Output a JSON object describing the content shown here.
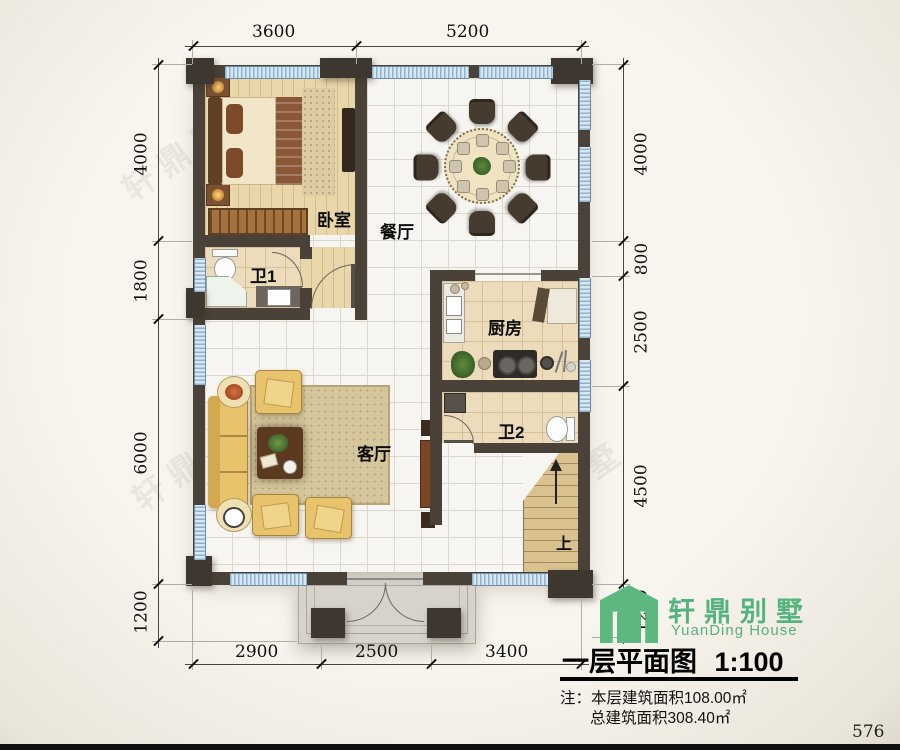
{
  "drawing": {
    "type": "floor-plan",
    "title": "一层平面图",
    "scale": "1:100",
    "page_number": "576",
    "watermark": "轩鼎别墅"
  },
  "title_block": {
    "logo_cn": "轩鼎别墅",
    "logo_en": "YuanDing House",
    "note_label": "注：",
    "note_line1": "本层建筑面积108.00㎡",
    "note_line2": "总建筑面积308.40㎡"
  },
  "rooms": {
    "bedroom": "卧室",
    "dining": "餐厅",
    "bath1": "卫1",
    "kitchen": "厨房",
    "living": "客厅",
    "bath2": "卫2",
    "stairs_up": "上"
  },
  "dims": {
    "top": [
      "3600",
      "5200"
    ],
    "left": [
      "4000",
      "1800",
      "6000",
      "1200"
    ],
    "right": [
      "4000",
      "800",
      "2500",
      "4500",
      "1200"
    ],
    "bottom": [
      "2900",
      "2500",
      "3400"
    ]
  }
}
